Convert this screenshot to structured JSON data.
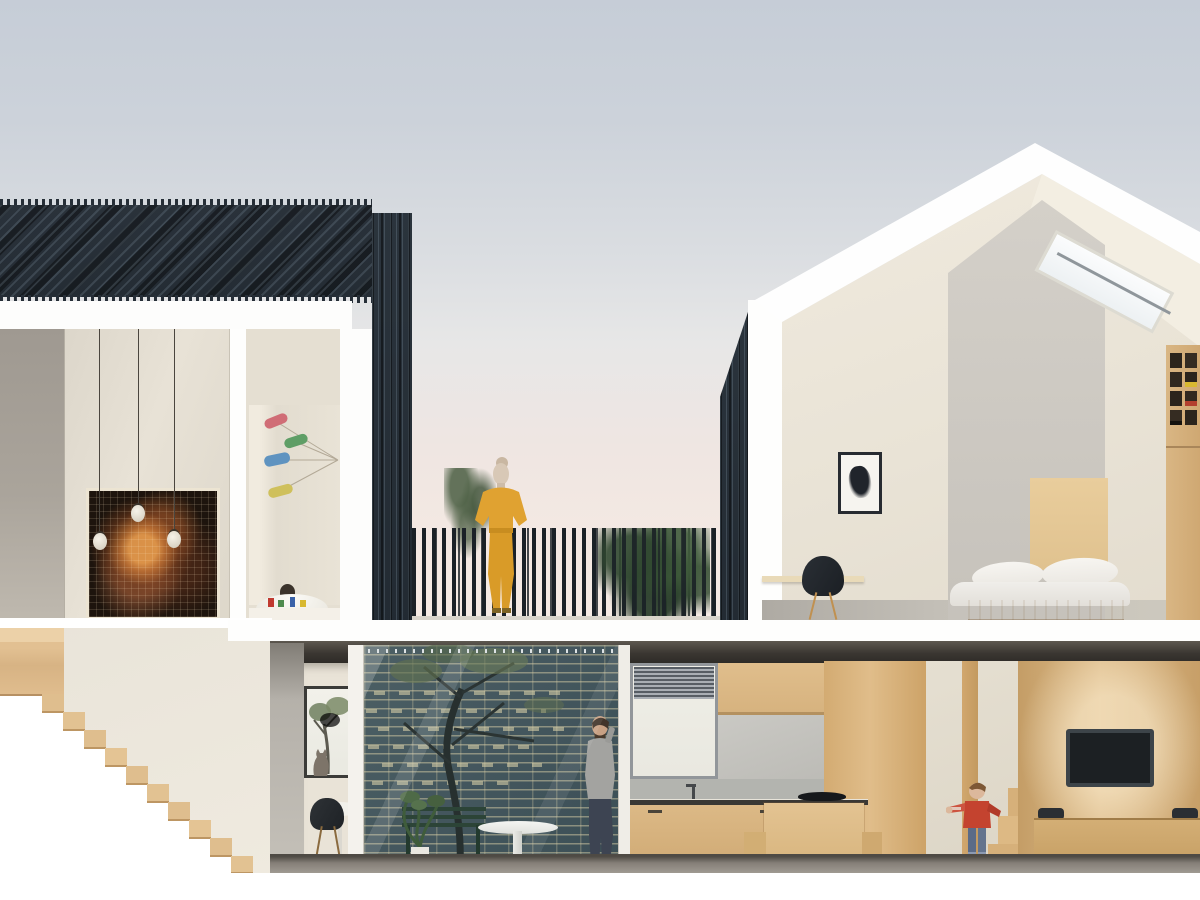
{
  "meta": {
    "type": "architectural-section-rendering",
    "view": "cross-section",
    "text_content": "none"
  },
  "palette": {
    "sky_top": "#c6cdd7",
    "sky_mid": "#e3e5e7",
    "sky_horizon_pink": "#f5e9e3",
    "roof_slats_dark": "#262e37",
    "section_cut_white": "#ffffff",
    "wall_grey": "#a29c94",
    "wall_cream": "#e7e1d5",
    "wood_light": "#dcba8a",
    "wood_mid": "#cda26a",
    "brick_teal": "#44575e",
    "mortar_tan": "#d7cda5",
    "slab_dark": "#35322d",
    "floor_grey": "#9b968e",
    "outfit_yellow": "#e0a231",
    "jacket_red": "#c4432f",
    "jeans_blue": "#5b6b87",
    "foliage_green": "#4e6a47",
    "tv_black": "#1c2023",
    "chair_black": "#22262a",
    "mobile_pink": "#d06d76",
    "mobile_green": "#5f9e66",
    "mobile_blue": "#5f93c0",
    "mobile_yellow": "#cfc05c"
  },
  "scene": {
    "upper_level": [
      "stair-void-with-pixel-painting",
      "pendant-bulbs",
      "nursery-with-mobile",
      "roof-terrace-with-woman",
      "gabled-bedroom-with-skylight"
    ],
    "lower_level": [
      "wooden-staircase",
      "dining-nook-with-cat",
      "glazed-courtyard-with-tree-and-man",
      "kitchen",
      "hallway-with-child",
      "living-room-with-tv"
    ],
    "people": [
      "woman-in-yellow-on-terrace",
      "man-on-phone-in-courtyard",
      "child-in-red-jacket"
    ],
    "animals": [
      "cat-on-windowsill"
    ]
  }
}
